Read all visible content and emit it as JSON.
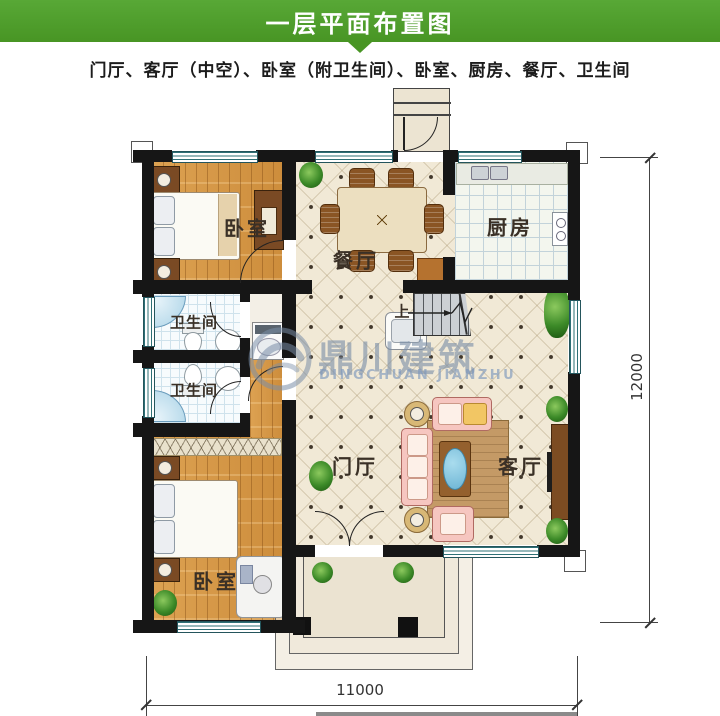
{
  "header": {
    "title": "一层平面布置图"
  },
  "subtitle": "门厅、客厅（中空）、卧室（附卫生间）、卧室、厨房、餐厅、卫生间",
  "rooms": {
    "bedroom_top": "卧室",
    "dining": "餐厅",
    "kitchen": "厨房",
    "bath_upper": "卫生间",
    "bath_lower": "卫生间",
    "hall": "门厅",
    "living": "客厅",
    "bedroom_bottom": "卧室"
  },
  "stairs": {
    "up": "上"
  },
  "dimensions": {
    "bottom": "11000",
    "right": "12000"
  },
  "watermark": {
    "cn": "鼎川建筑",
    "en": "DINGCHUAN JIANZHU"
  },
  "colors": {
    "header_green": "#4e9c2c",
    "wall_black": "#161616",
    "wood_floor": "#d79a4c",
    "tile_cream": "#f1e9d6",
    "window_teal": "#2e7076",
    "watermark_blue": "#7e93ad",
    "sofa_pink": "#f6c6c0"
  }
}
